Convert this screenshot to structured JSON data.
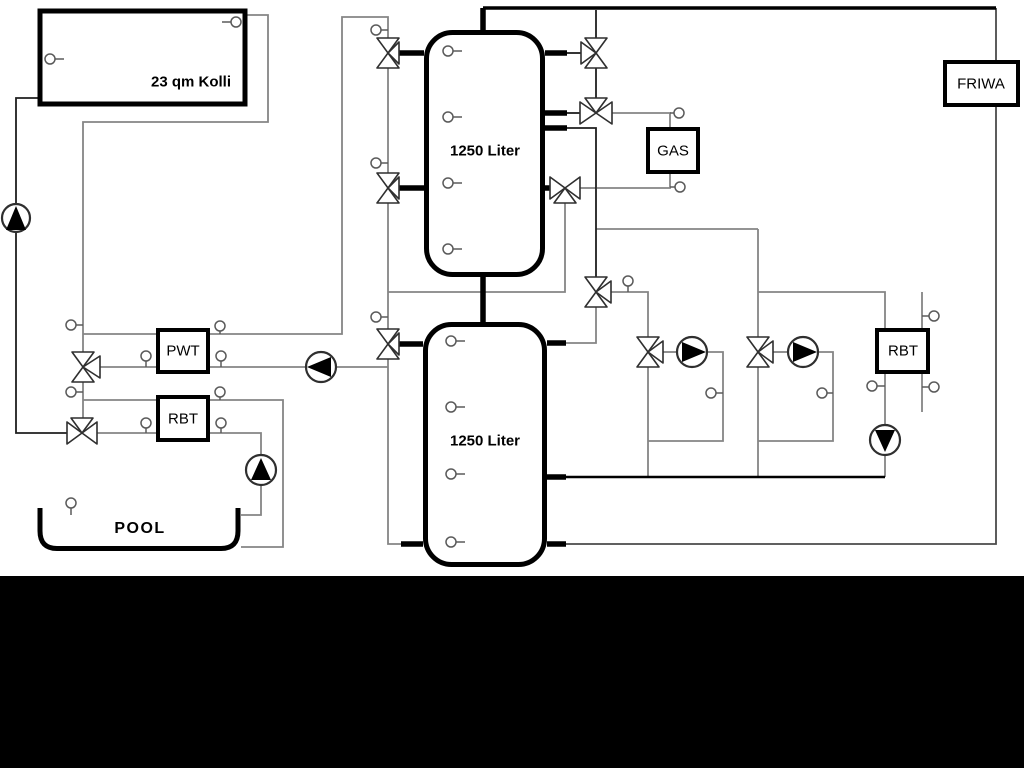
{
  "labels": {
    "collector": "23 qm Kolli",
    "tank_upper": "1250 Liter",
    "tank_lower": "1250 Liter",
    "pwt": "PWT",
    "rbt_left": "RBT",
    "gas": "GAS",
    "friwa": "FRIWA",
    "rbt_right": "RBT",
    "pool": "POOL"
  },
  "colors": {
    "background": "#ffffff",
    "mask": "#000000",
    "line_gray": "#858585",
    "line_dark": "#1f1f1f",
    "box_border": "#000000"
  }
}
